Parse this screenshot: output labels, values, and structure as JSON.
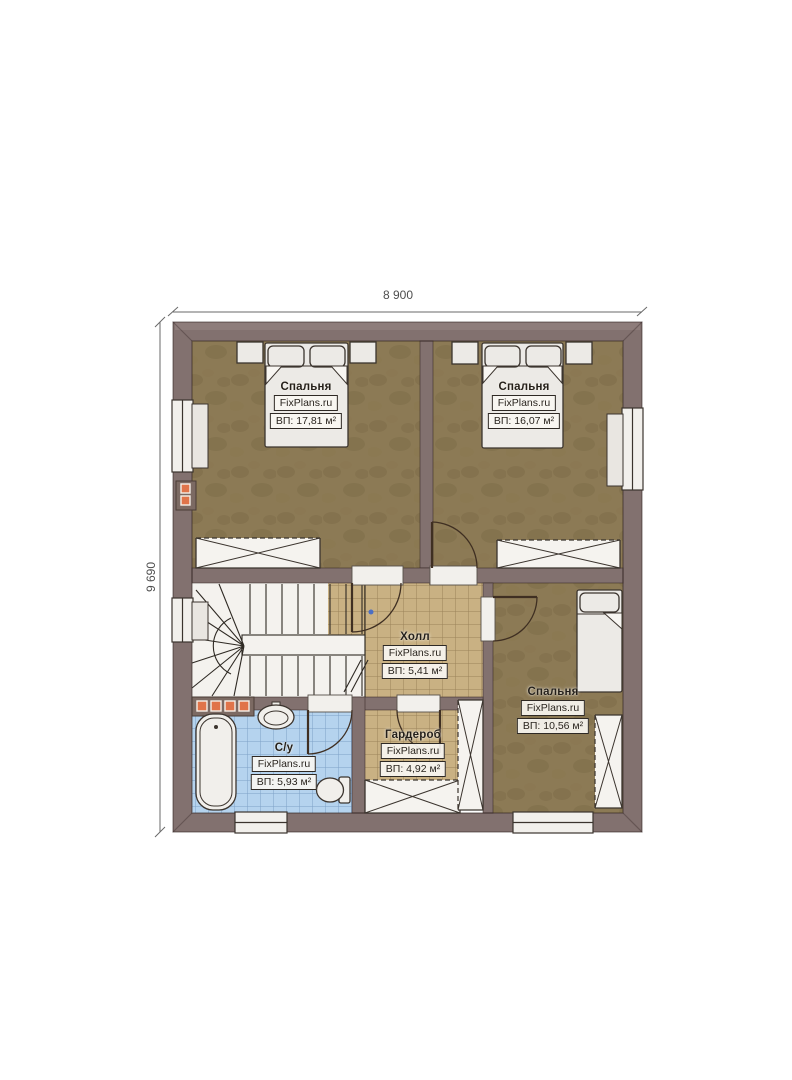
{
  "plan": {
    "dimension_width": "8 900",
    "dimension_height": "9 690",
    "watermark": "FixPlans.ru",
    "rooms": [
      {
        "id": "bedroom-1",
        "name": "Спальня",
        "area": "ВП: 17,81 м²"
      },
      {
        "id": "bedroom-2",
        "name": "Спальня",
        "area": "ВП: 16,07 м²"
      },
      {
        "id": "hall",
        "name": "Холл",
        "area": "ВП: 5,41 м²"
      },
      {
        "id": "bedroom-3",
        "name": "Спальня",
        "area": "ВП: 10,56 м²"
      },
      {
        "id": "wardrobe",
        "name": "Гардероб",
        "area": "ВП: 4,92 м²"
      },
      {
        "id": "bathroom",
        "name": "С/у",
        "area": "ВП: 5,93 м²"
      }
    ],
    "colors": {
      "wall": "#82716f",
      "bedroom_floor": "#8c7a55",
      "tile_floor": "#c9b183",
      "bathroom_floor": "#b5d3ee",
      "flue_accent": "#e0744a",
      "fixture_white": "#f2f0ec"
    }
  }
}
